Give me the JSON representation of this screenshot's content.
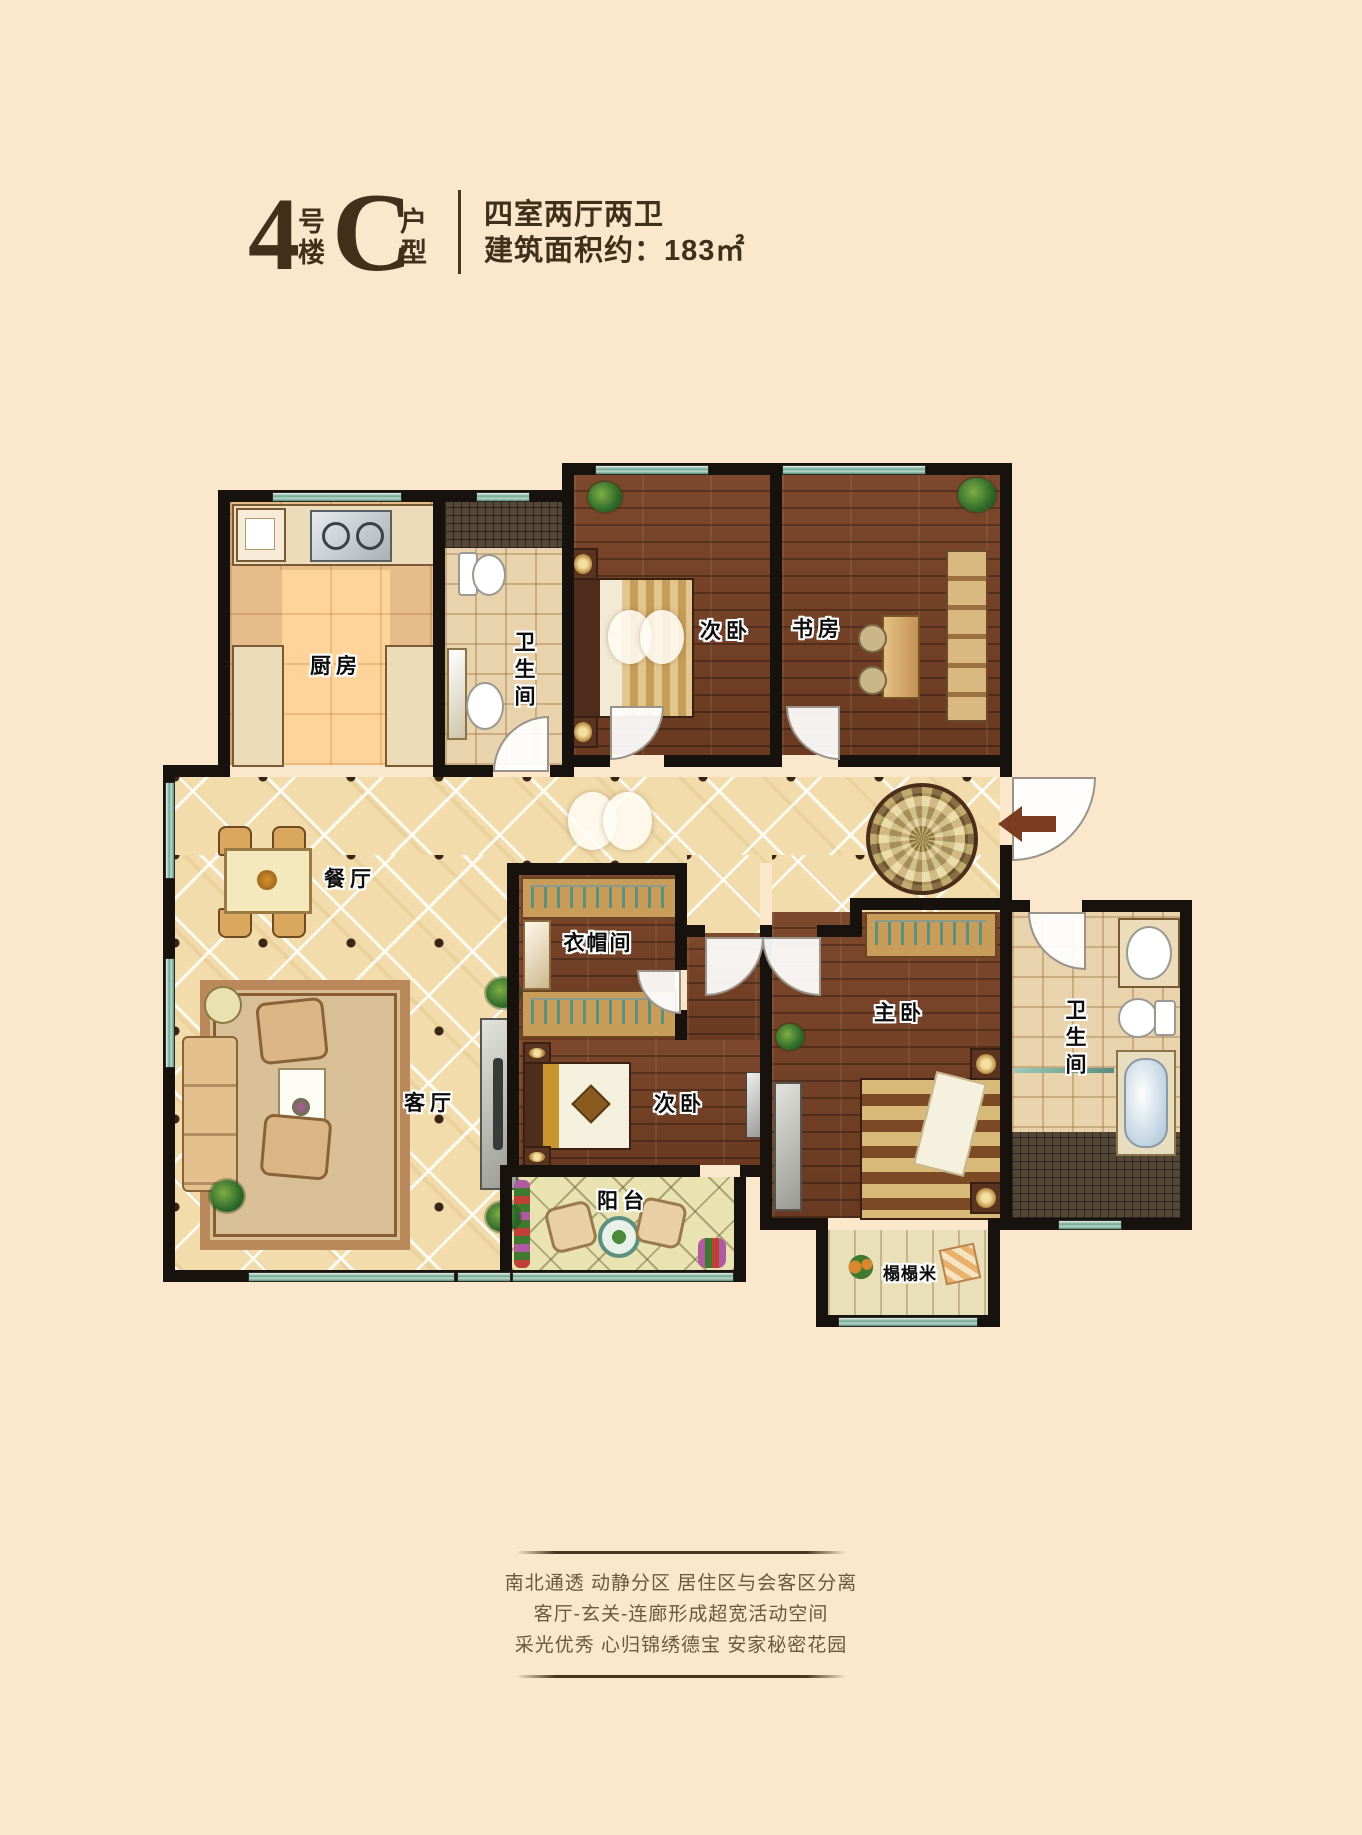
{
  "header": {
    "building_number": "4",
    "building_suffix_top": "号",
    "building_suffix_bottom": "楼",
    "unit_letter": "C",
    "unit_suffix_top": "户",
    "unit_suffix_bottom": "型",
    "spec_rooms": "四室两厅两卫",
    "spec_area_label": "建筑面积约：",
    "spec_area_value": "183㎡"
  },
  "floorplan": {
    "rooms": {
      "kitchen": "厨房",
      "bath1": "卫生间",
      "bedroom2": "次卧",
      "study": "书房",
      "dining": "餐厅",
      "living": "客厅",
      "closet": "衣帽间",
      "bedroom3": "次卧",
      "balcony": "阳台",
      "master": "主卧",
      "bath2": "卫生间",
      "tatami": "榻榻米"
    }
  },
  "footer": {
    "line1": "南北通透 动静分区 居住区与会客区分离",
    "line2": "客厅-玄关-连廊形成超宽活动空间",
    "line3": "采光优秀 心归锦绣德宝 安家秘密花园"
  },
  "colors": {
    "background": "#fbe8cc",
    "title_text": "#42301b",
    "wall": "#17120e",
    "window_glass": "#6fa695",
    "wood_floor": "#74412a",
    "tile_floor": "#f2dcab",
    "footer_text": "#6e5740",
    "entry_arrow": "#7b3c1f"
  }
}
